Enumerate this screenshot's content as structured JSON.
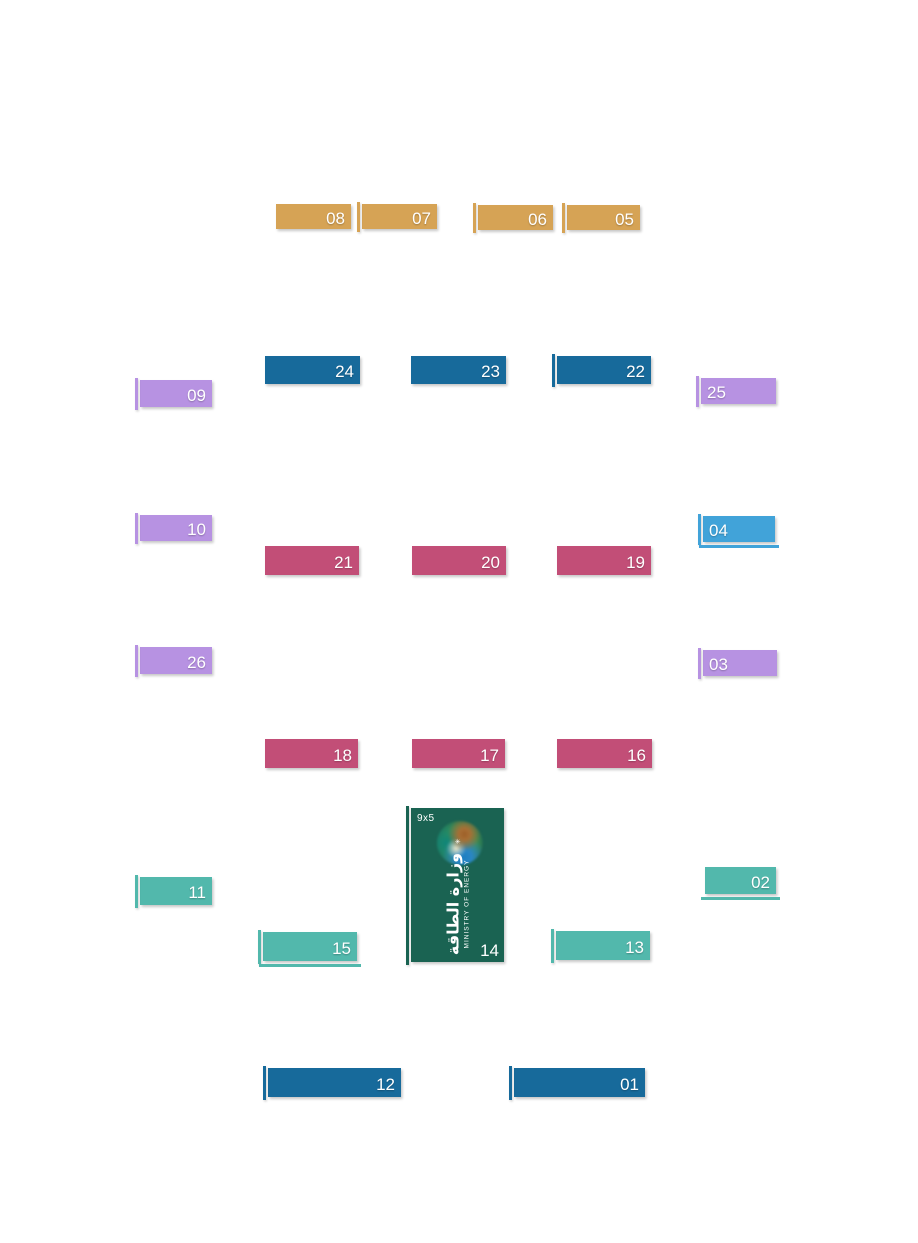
{
  "map": {
    "title": "exhibition-booth-floor-plan",
    "palette": {
      "gold": "#d6a355",
      "blue": "#176a9b",
      "purple": "#b792e2",
      "lightblue": "#41a3d9",
      "pink": "#c24e77",
      "teal": "#52b8ac",
      "green": "#1a6352",
      "text": "#ffffff",
      "background": "#ffffff"
    },
    "booths": [
      {
        "number": "08",
        "color": "gold",
        "x": 276,
        "y": 204,
        "w": 75,
        "h": 25,
        "align": "right",
        "bar": false,
        "underline": false
      },
      {
        "number": "07",
        "color": "gold",
        "x": 362,
        "y": 204,
        "w": 75,
        "h": 25,
        "align": "right",
        "bar": true,
        "underline": false
      },
      {
        "number": "06",
        "color": "gold",
        "x": 478,
        "y": 205,
        "w": 75,
        "h": 25,
        "align": "right",
        "bar": true,
        "underline": false
      },
      {
        "number": "05",
        "color": "gold",
        "x": 567,
        "y": 205,
        "w": 73,
        "h": 25,
        "align": "right",
        "bar": true,
        "underline": false
      },
      {
        "number": "24",
        "color": "blue",
        "x": 265,
        "y": 356,
        "w": 95,
        "h": 28,
        "align": "right",
        "bar": false,
        "underline": false
      },
      {
        "number": "23",
        "color": "blue",
        "x": 411,
        "y": 356,
        "w": 95,
        "h": 28,
        "align": "right",
        "bar": false,
        "underline": false
      },
      {
        "number": "22",
        "color": "blue",
        "x": 557,
        "y": 356,
        "w": 94,
        "h": 28,
        "align": "right",
        "bar": true,
        "underline": false
      },
      {
        "number": "09",
        "color": "purple",
        "x": 140,
        "y": 380,
        "w": 72,
        "h": 27,
        "align": "right",
        "bar": true,
        "underline": false
      },
      {
        "number": "25",
        "color": "purple",
        "x": 701,
        "y": 378,
        "w": 75,
        "h": 26,
        "align": "left",
        "bar": true,
        "underline": false
      },
      {
        "number": "10",
        "color": "purple",
        "x": 140,
        "y": 515,
        "w": 72,
        "h": 26,
        "align": "right",
        "bar": true,
        "underline": false
      },
      {
        "number": "04",
        "color": "lightblue",
        "x": 703,
        "y": 516,
        "w": 72,
        "h": 26,
        "align": "left",
        "bar": true,
        "underline": true
      },
      {
        "number": "21",
        "color": "pink",
        "x": 265,
        "y": 546,
        "w": 94,
        "h": 29,
        "align": "right",
        "bar": false,
        "underline": false
      },
      {
        "number": "20",
        "color": "pink",
        "x": 412,
        "y": 546,
        "w": 94,
        "h": 29,
        "align": "right",
        "bar": false,
        "underline": false
      },
      {
        "number": "19",
        "color": "pink",
        "x": 557,
        "y": 546,
        "w": 94,
        "h": 29,
        "align": "right",
        "bar": false,
        "underline": false
      },
      {
        "number": "26",
        "color": "purple",
        "x": 140,
        "y": 647,
        "w": 72,
        "h": 27,
        "align": "right",
        "bar": true,
        "underline": false
      },
      {
        "number": "03",
        "color": "purple",
        "x": 703,
        "y": 650,
        "w": 74,
        "h": 26,
        "align": "left",
        "bar": true,
        "underline": false
      },
      {
        "number": "18",
        "color": "pink",
        "x": 265,
        "y": 739,
        "w": 93,
        "h": 29,
        "align": "right",
        "bar": false,
        "underline": false
      },
      {
        "number": "17",
        "color": "pink",
        "x": 412,
        "y": 739,
        "w": 93,
        "h": 29,
        "align": "right",
        "bar": false,
        "underline": false
      },
      {
        "number": "16",
        "color": "pink",
        "x": 557,
        "y": 739,
        "w": 95,
        "h": 29,
        "align": "right",
        "bar": false,
        "underline": false
      },
      {
        "number": "14",
        "color": "green",
        "x": 411,
        "y": 808,
        "w": 93,
        "h": 154,
        "align": "right",
        "bar": true,
        "underline": false,
        "type": "ministry",
        "size_label": "9x5",
        "name_ar": "وزارة الطاقة",
        "name_en": "MINISTRY OF ENERGY"
      },
      {
        "number": "11",
        "color": "teal",
        "x": 140,
        "y": 877,
        "w": 72,
        "h": 28,
        "align": "right",
        "bar": true,
        "underline": false
      },
      {
        "number": "02",
        "color": "teal",
        "x": 705,
        "y": 867,
        "w": 71,
        "h": 27,
        "align": "right",
        "bar": false,
        "underline": true
      },
      {
        "number": "15",
        "color": "teal",
        "x": 263,
        "y": 932,
        "w": 94,
        "h": 29,
        "align": "right",
        "bar": true,
        "underline": true
      },
      {
        "number": "13",
        "color": "teal",
        "x": 556,
        "y": 931,
        "w": 94,
        "h": 29,
        "align": "right",
        "bar": true,
        "underline": false
      },
      {
        "number": "12",
        "color": "blue",
        "x": 268,
        "y": 1068,
        "w": 133,
        "h": 29,
        "align": "right",
        "bar": true,
        "underline": false
      },
      {
        "number": "01",
        "color": "blue",
        "x": 514,
        "y": 1068,
        "w": 131,
        "h": 29,
        "align": "right",
        "bar": true,
        "underline": false
      }
    ]
  }
}
